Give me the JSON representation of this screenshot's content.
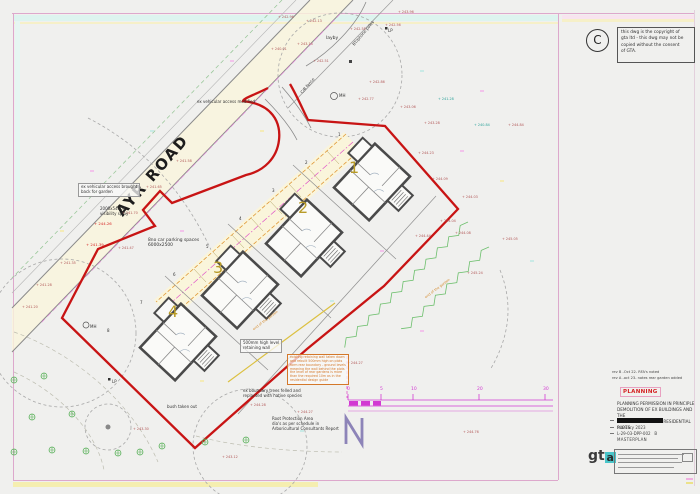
{
  "plan": {
    "road_label": "AYR ROAD",
    "north_label": "N",
    "plots": [
      {
        "number": "1",
        "x": 349,
        "y": 160
      },
      {
        "number": "2",
        "x": 298,
        "y": 200
      },
      {
        "number": "3",
        "x": 213,
        "y": 260
      },
      {
        "number": "4",
        "x": 168,
        "y": 304
      }
    ],
    "boundary_digits": [
      {
        "t": "1",
        "x": 338,
        "y": 133
      },
      {
        "t": "2",
        "x": 305,
        "y": 161
      },
      {
        "t": "3",
        "x": 272,
        "y": 189
      },
      {
        "t": "4",
        "x": 239,
        "y": 217
      },
      {
        "t": "5",
        "x": 206,
        "y": 245
      },
      {
        "t": "6",
        "x": 173,
        "y": 273
      },
      {
        "t": "7",
        "x": 140,
        "y": 301
      },
      {
        "t": "8",
        "x": 107,
        "y": 329
      }
    ],
    "levels": [
      {
        "t": "242.96",
        "x": 278,
        "y": 16
      },
      {
        "t": "242.13",
        "x": 306,
        "y": 20
      },
      {
        "t": "242.55",
        "x": 350,
        "y": 28
      },
      {
        "t": "242.56",
        "x": 385,
        "y": 24
      },
      {
        "t": "243.96",
        "x": 398,
        "y": 11
      },
      {
        "t": "240.01",
        "x": 271,
        "y": 48
      },
      {
        "t": "243.14",
        "x": 297,
        "y": 43
      },
      {
        "t": "242.51",
        "x": 313,
        "y": 60
      },
      {
        "t": "242.86",
        "x": 369,
        "y": 81
      },
      {
        "t": "242.77",
        "x": 358,
        "y": 98
      },
      {
        "t": "243.06",
        "x": 400,
        "y": 106
      },
      {
        "t": "243.28",
        "x": 424,
        "y": 122
      },
      {
        "t": "241.58",
        "x": 176,
        "y": 160
      },
      {
        "t": "241.65",
        "x": 146,
        "y": 186
      },
      {
        "t": "241.70",
        "x": 122,
        "y": 212
      },
      {
        "t": "241.47",
        "x": 118,
        "y": 247
      },
      {
        "t": "244.26",
        "x": 94,
        "y": 222,
        "c": "red"
      },
      {
        "t": "241.39",
        "x": 86,
        "y": 243,
        "c": "red"
      },
      {
        "t": "241.35",
        "x": 60,
        "y": 262
      },
      {
        "t": "241.28",
        "x": 36,
        "y": 284
      },
      {
        "t": "241.20",
        "x": 22,
        "y": 306
      },
      {
        "t": "241.28",
        "x": 438,
        "y": 98,
        "c": "teal"
      },
      {
        "t": "240.84",
        "x": 474,
        "y": 124,
        "c": "teal"
      },
      {
        "t": "244.84",
        "x": 508,
        "y": 124
      },
      {
        "t": "244.09",
        "x": 432,
        "y": 178
      },
      {
        "t": "244.23",
        "x": 418,
        "y": 152
      },
      {
        "t": "244.03",
        "x": 462,
        "y": 196
      },
      {
        "t": "244.04",
        "x": 440,
        "y": 220
      },
      {
        "t": "244.08",
        "x": 455,
        "y": 232
      },
      {
        "t": "244.44",
        "x": 415,
        "y": 235
      },
      {
        "t": "245.05",
        "x": 502,
        "y": 238
      },
      {
        "t": "245.24",
        "x": 467,
        "y": 272
      },
      {
        "t": "244.27",
        "x": 347,
        "y": 362
      },
      {
        "t": "244.28",
        "x": 250,
        "y": 404
      },
      {
        "t": "244.27",
        "x": 297,
        "y": 411
      },
      {
        "t": "244.76",
        "x": 463,
        "y": 431
      },
      {
        "t": "243.30",
        "x": 133,
        "y": 428
      },
      {
        "t": "243.12",
        "x": 222,
        "y": 456
      }
    ],
    "annotations": [
      {
        "x": 197,
        "y": 100,
        "lines": [
          "ex vehicular access modified"
        ]
      },
      {
        "x": 78,
        "y": 183,
        "boxed": true,
        "lines": [
          "ex vehicular access brought",
          "back for garden"
        ]
      },
      {
        "x": 100,
        "y": 207,
        "lines": [
          "2000x54000",
          "visibility splay"
        ]
      },
      {
        "x": 148,
        "y": 238,
        "size": 4.4,
        "lines": [
          "8no car parking spaces",
          "6000x2500"
        ]
      },
      {
        "x": 240,
        "y": 339,
        "boxed": true,
        "lines": [
          "500mm high level",
          "retaining wall"
        ]
      },
      {
        "x": 243,
        "y": 389,
        "lines": [
          "ex boundary trees felled and",
          "replanted with native species"
        ]
      },
      {
        "x": 272,
        "y": 417,
        "lines": [
          "Root Protection Area",
          "dia's as per schedule in",
          "Arboricultural Consultants Report"
        ]
      },
      {
        "x": 167,
        "y": 405,
        "lines": [
          "bush taken out"
        ]
      },
      {
        "x": 326,
        "y": 36,
        "size": 4.5,
        "lines": [
          "layby"
        ]
      },
      {
        "x": 352,
        "y": 44,
        "rot": -50,
        "lines": [
          "BT/phone poles"
        ]
      },
      {
        "x": 300,
        "y": 92,
        "rot": -50,
        "lines": [
          "C/B fence"
        ]
      },
      {
        "x": 339,
        "y": 94,
        "lines": [
          "MH"
        ]
      },
      {
        "x": 90,
        "y": 325,
        "lines": [
          "MH"
        ]
      },
      {
        "x": 388,
        "y": 29,
        "lines": [
          "LP"
        ]
      },
      {
        "x": 112,
        "y": 380,
        "lines": [
          "LP"
        ]
      },
      {
        "x": 252,
        "y": 328,
        "rot": -37,
        "color": "#d4892a",
        "size": 3.4,
        "lines": [
          "end of the garden"
        ]
      },
      {
        "x": 424,
        "y": 296,
        "rot": -37,
        "color": "#d4892a",
        "size": 3.4,
        "lines": [
          "end of the garden"
        ]
      },
      {
        "x": 287,
        "y": 354,
        "boxed": true,
        "color": "#d4782a",
        "size": 3.2,
        "lines": [
          "existing retaining wall taken down",
          "and rebuilt 500mm high on plots",
          "form rear boundary - ground levels",
          "meaning the wall behind the plots",
          "the level of rear gardens is more",
          "than the required 10m as in the",
          "residential design guide"
        ]
      }
    ],
    "scale_bar": {
      "ticks": [
        {
          "t": "0",
          "x": 347
        },
        {
          "t": "5",
          "x": 380
        },
        {
          "t": "10",
          "x": 411
        },
        {
          "t": "20",
          "x": 477
        },
        {
          "t": "30",
          "x": 543
        }
      ]
    }
  },
  "title_block": {
    "copyright_symbol": "C",
    "copyright_text": [
      "this dwg is the copyright of",
      "gta ltd - this dwg may not be",
      "copied without the consent",
      "of GTA."
    ],
    "revisions": [
      "rev B -Oct 22- RFA's noted",
      "rev A -oct 23- notes rear garden added"
    ],
    "status": "PLANNING",
    "description": [
      "PLANNING PERMISSION IN PRINCIPLE",
      "DEMOLITION OF EX BUILDINGS AND THE",
      "FORMATION OF FOUR RESIDENTIAL PLOTS."
    ],
    "date": "february 2023",
    "drawing_number": "L-29-03-DPP-002",
    "revision_letter": "B",
    "drawing_name": "MASTERPLAN",
    "logo_text": "gt",
    "logo_accent_letter": "a"
  },
  "colors": {
    "boundary_red": "#c81414",
    "plot_number_olive": "#b89b28",
    "scale_magenta": "#d23ad2",
    "logo_teal": "#49c5c9",
    "hedge_green": "#6cbf6c",
    "level_maroon": "#b25858"
  }
}
